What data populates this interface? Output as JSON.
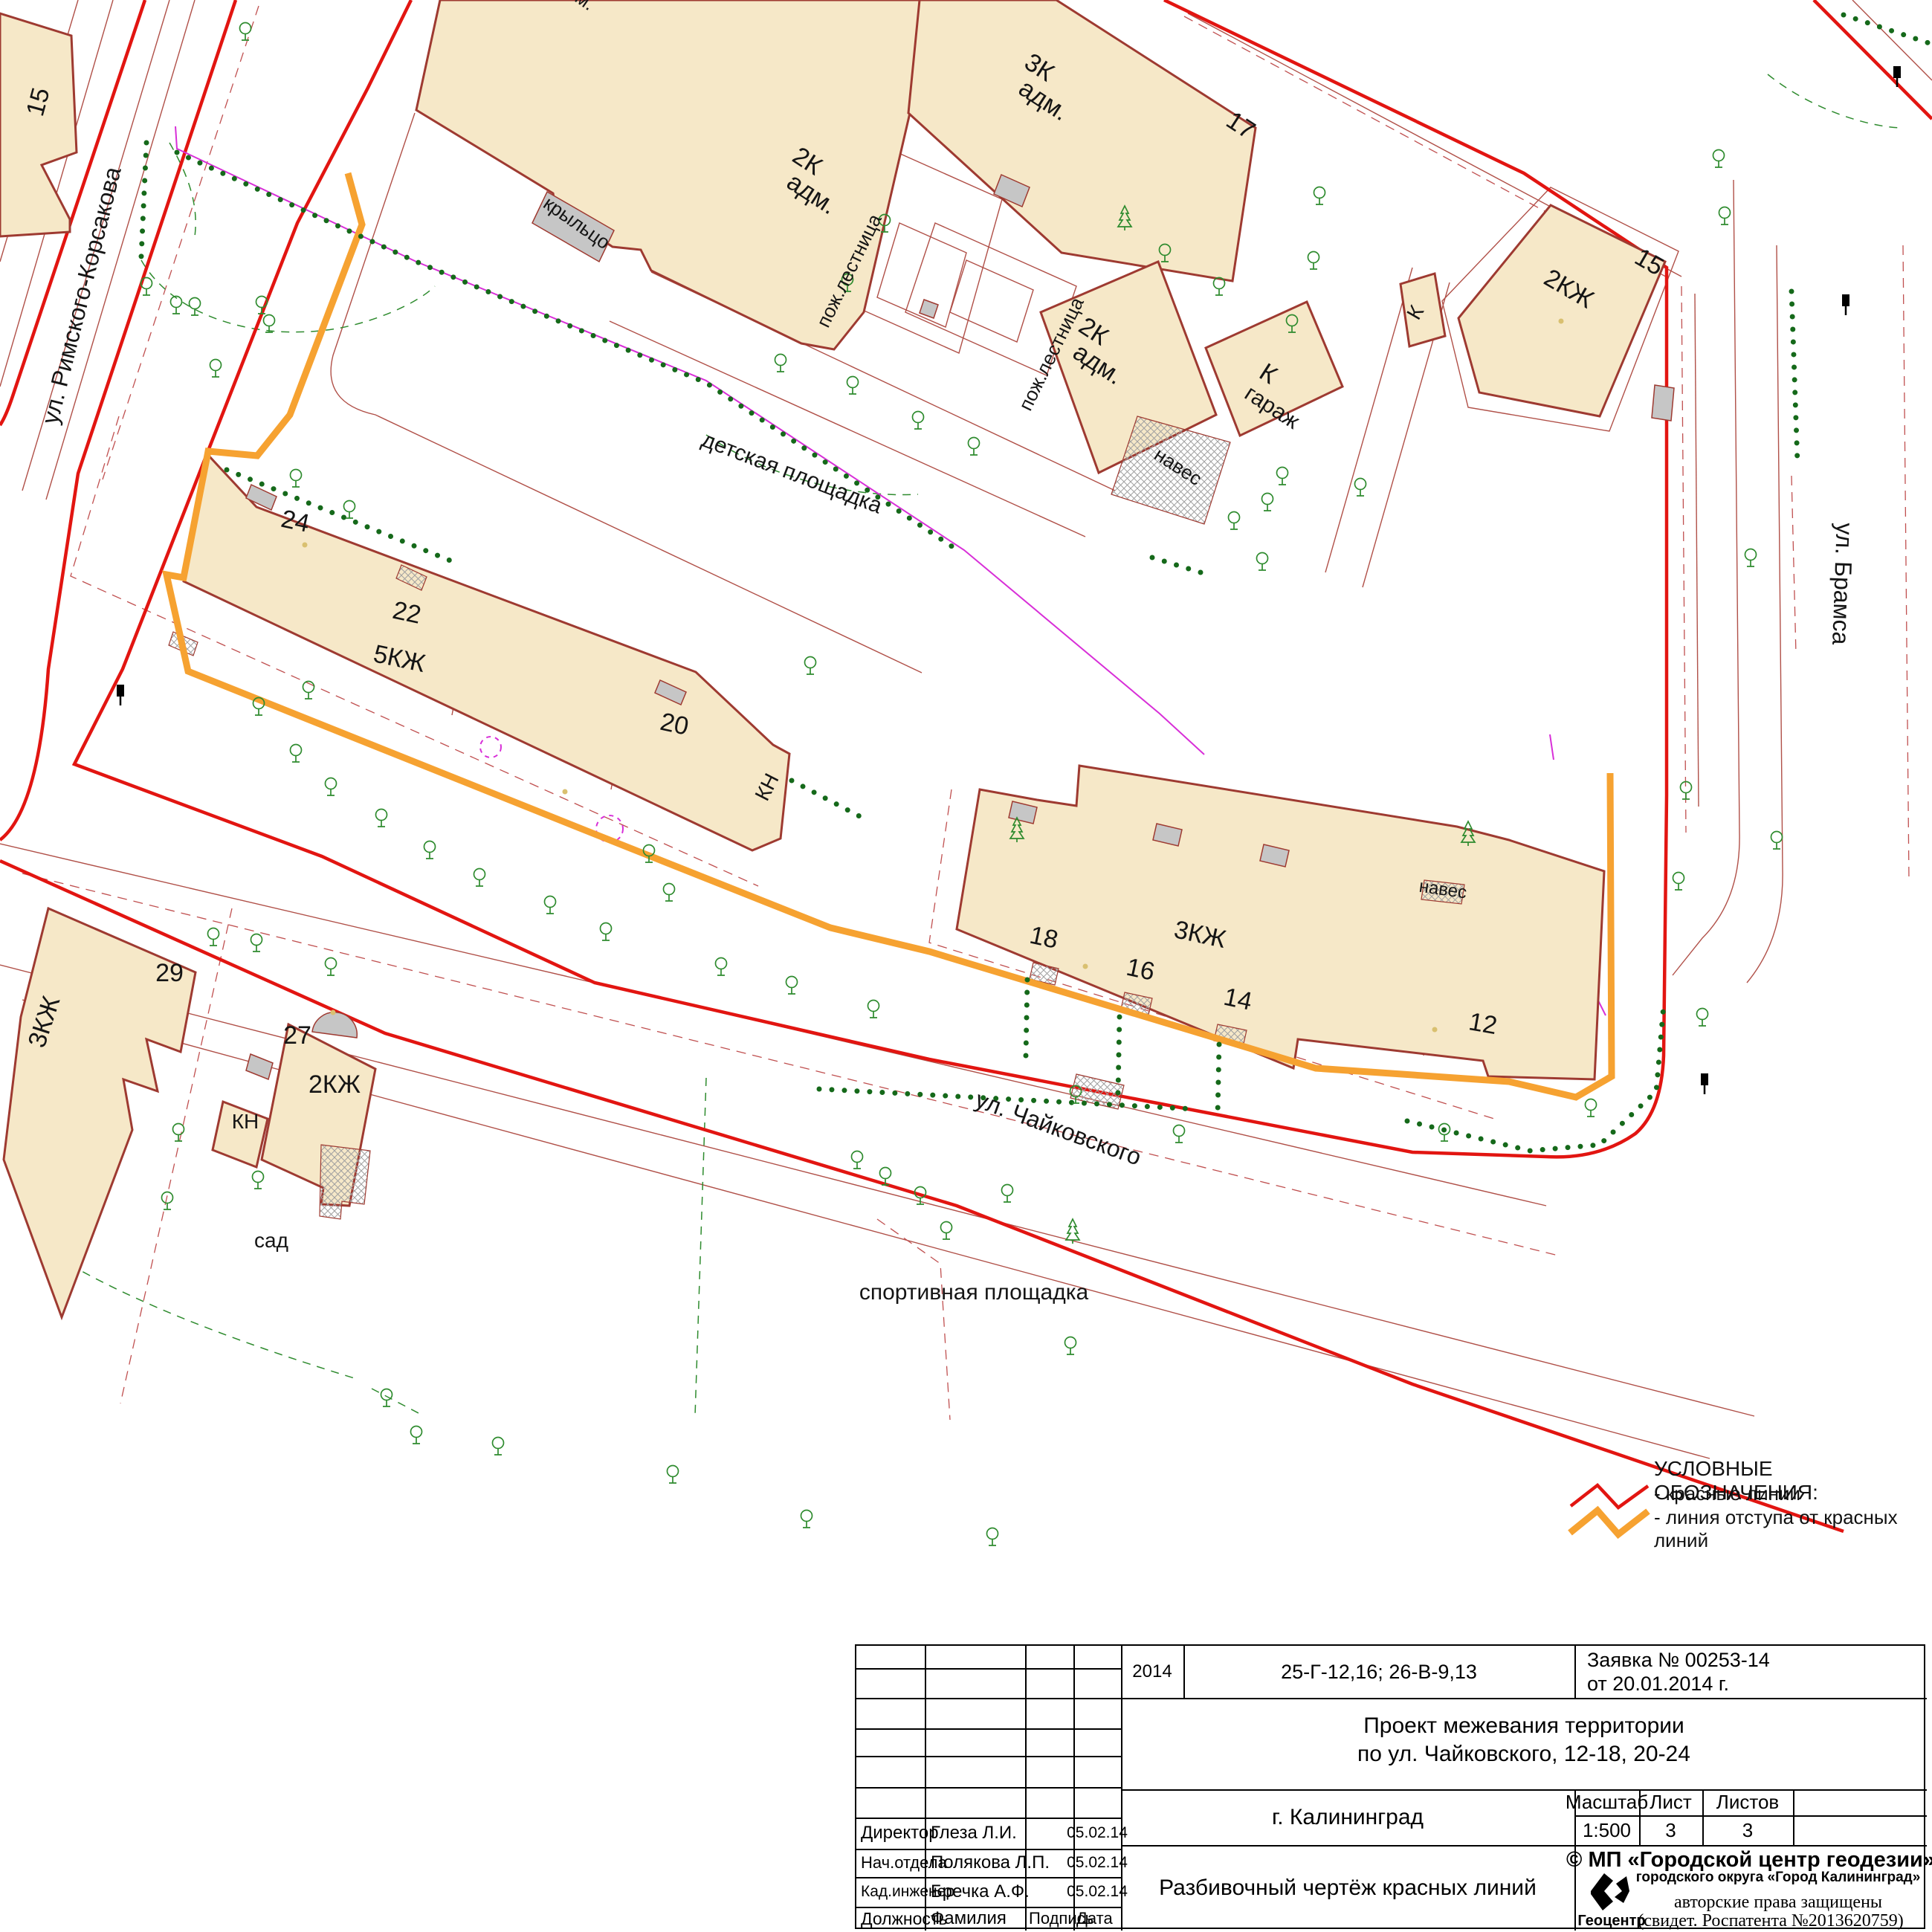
{
  "map": {
    "streets": {
      "rimskogo": "ул. Римского-Корсакова",
      "bramsa": "ул. Брамса",
      "tchaikovskogo": "ул. Чайковского"
    },
    "areas": {
      "detskaya": "детская площадка",
      "sport": "спортивная площадка",
      "sad": "сад"
    },
    "labels": {
      "b15": "15",
      "cut_m": "м.",
      "adm2k_1a": "2К",
      "adm2k_1b": "адм.",
      "kryltso": "крыльцо",
      "pozh1": "пож.лестница",
      "adm3k_a": "3К",
      "adm3k_b": "адм.",
      "n17": "17",
      "adm2k_2a": "2К",
      "adm2k_2b": "адм.",
      "pozh2": "пож.лестница",
      "gar_a": "К",
      "gar_b": "гараж",
      "naves1": "навес",
      "k_small": "К",
      "b2kzh15": "2КЖ",
      "n15": "15",
      "n24": "24",
      "n22": "22",
      "b5kzh": "5КЖ",
      "n20": "20",
      "kn1": "КН",
      "b3kzh_i": "3КЖ",
      "n18": "18",
      "n16": "16",
      "n14": "14",
      "n12": "12",
      "naves2": "навес",
      "n29": "29",
      "b3kzh_j": "3КЖ",
      "n27": "27",
      "b2kzh27": "2КЖ",
      "kn2": "КН"
    }
  },
  "legend": {
    "title": "УСЛОВНЫЕ ОБОЗНАЧЕНИЯ:",
    "red_label": "- красные линии",
    "orange_label": "- линия отступа от красных линий",
    "red_color": "#e21511",
    "orange_color": "#f6a231"
  },
  "title_block": {
    "year": "2014",
    "sheet_code": "25-Г-12,16; 26-В-9,13",
    "request_line1": "Заявка № 00253-14",
    "request_line2": "от 20.01.2014 г.",
    "project_line1": "Проект межевания территории",
    "project_line2": "по ул. Чайковского, 12-18, 20-24",
    "city": "г. Калининград",
    "scale_label": "Масштаб",
    "scale_value": "1:500",
    "sheet_label": "Лист",
    "sheet_value": "3",
    "sheets_label": "Листов",
    "sheets_value": "3",
    "drawing_title": "Разбивочный чертёж красных линий",
    "org_line1": "© МП «Городской центр геодезии»",
    "org_line2": "городского округа «Город Калининград»",
    "logo_text": "Геоцентр",
    "copyright_line1": "авторские права защищены",
    "copyright_line2": "(свидет. Роспатента №2013620759)",
    "header_position": "Должность",
    "header_name": "Фамилия",
    "header_sign": "Подпись",
    "header_date": "Дата",
    "rows": [
      {
        "position": "Директор",
        "name": "Глеза Л.И.",
        "date": "05.02.14"
      },
      {
        "position": "Нач.отдела",
        "name": "Полякова Л.П.",
        "date": "05.02.14"
      },
      {
        "position": "Кад.инженер",
        "name": "Бречка А.Ф.",
        "date": "05.02.14"
      }
    ]
  }
}
